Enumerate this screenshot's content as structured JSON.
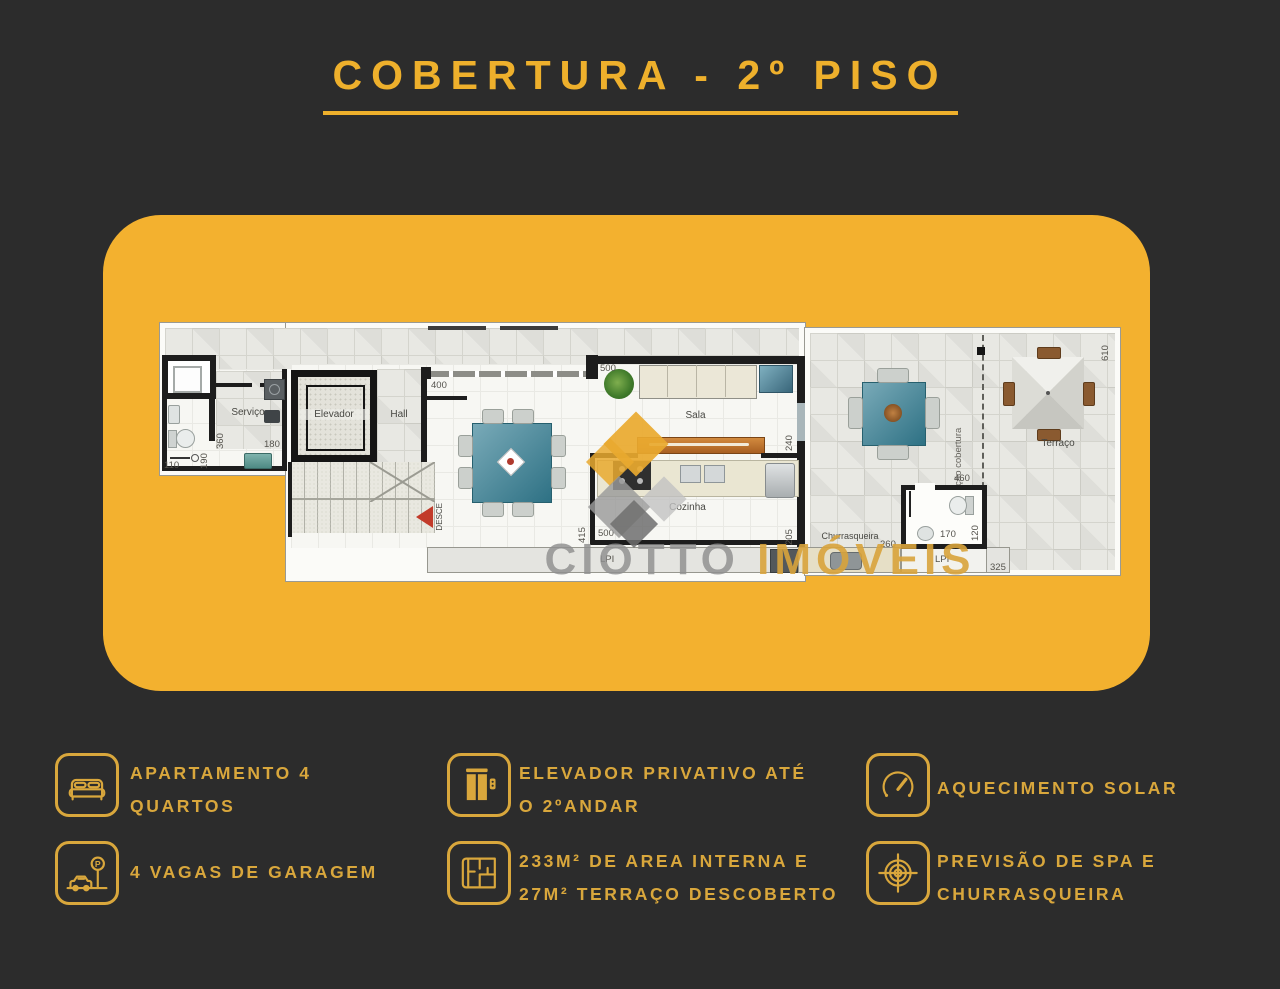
{
  "title": {
    "text": "COBERTURA - 2º PISO"
  },
  "colors": {
    "background": "#2c2c2c",
    "card_yellow": "#f3b12f",
    "gold": "#d9a73c",
    "title_gold": "#eeb02c",
    "wall_black": "#1d1d1d",
    "desce_red": "#c23b2a"
  },
  "watermark": {
    "brand_gray": "CIOTTO",
    "brand_gold": "IMÓVEIS"
  },
  "plan": {
    "labels": {
      "servico": "Serviço",
      "elevador": "Elevador",
      "hall": "Hall",
      "sala": "Sala",
      "cozinha": "Cozinha",
      "churrasqueira": "Churrasqueira",
      "terraco": "Terraço",
      "projecao_cobertura": "Projeção cobertura",
      "desce": "DESCE",
      "lpi_kitchen": "LPI",
      "lpi_terrace": "LPI"
    },
    "dims": {
      "d110": "110",
      "d190": "190",
      "d360": "360",
      "d180": "180",
      "d400": "400",
      "d500_sala": "500",
      "d240": "240",
      "d415": "415",
      "d500_cozinha": "500",
      "d205": "205",
      "d460": "460",
      "d170": "170",
      "d120": "120",
      "d260": "260",
      "d325": "325",
      "d610": "610"
    }
  },
  "features": [
    {
      "icon": "bed-icon",
      "line1": "APARTAMENTO 4",
      "line2": "QUARTOS"
    },
    {
      "icon": "parking-icon",
      "line1": "4 VAGAS DE GARAGEM",
      "line2": ""
    },
    {
      "icon": "elevator-icon",
      "line1": "ELEVADOR PRIVATIVO ATÉ",
      "line2": "O 2ºANDAR"
    },
    {
      "icon": "floorplan-icon",
      "line1": "233M² DE AREA INTERNA E",
      "line2": "27M² TERRAÇO DESCOBERTO"
    },
    {
      "icon": "gauge-icon",
      "line1": "AQUECIMENTO SOLAR",
      "line2": ""
    },
    {
      "icon": "target-icon",
      "line1": "PREVISÃO DE SPA E",
      "line2": "CHURRASQUEIRA"
    }
  ]
}
